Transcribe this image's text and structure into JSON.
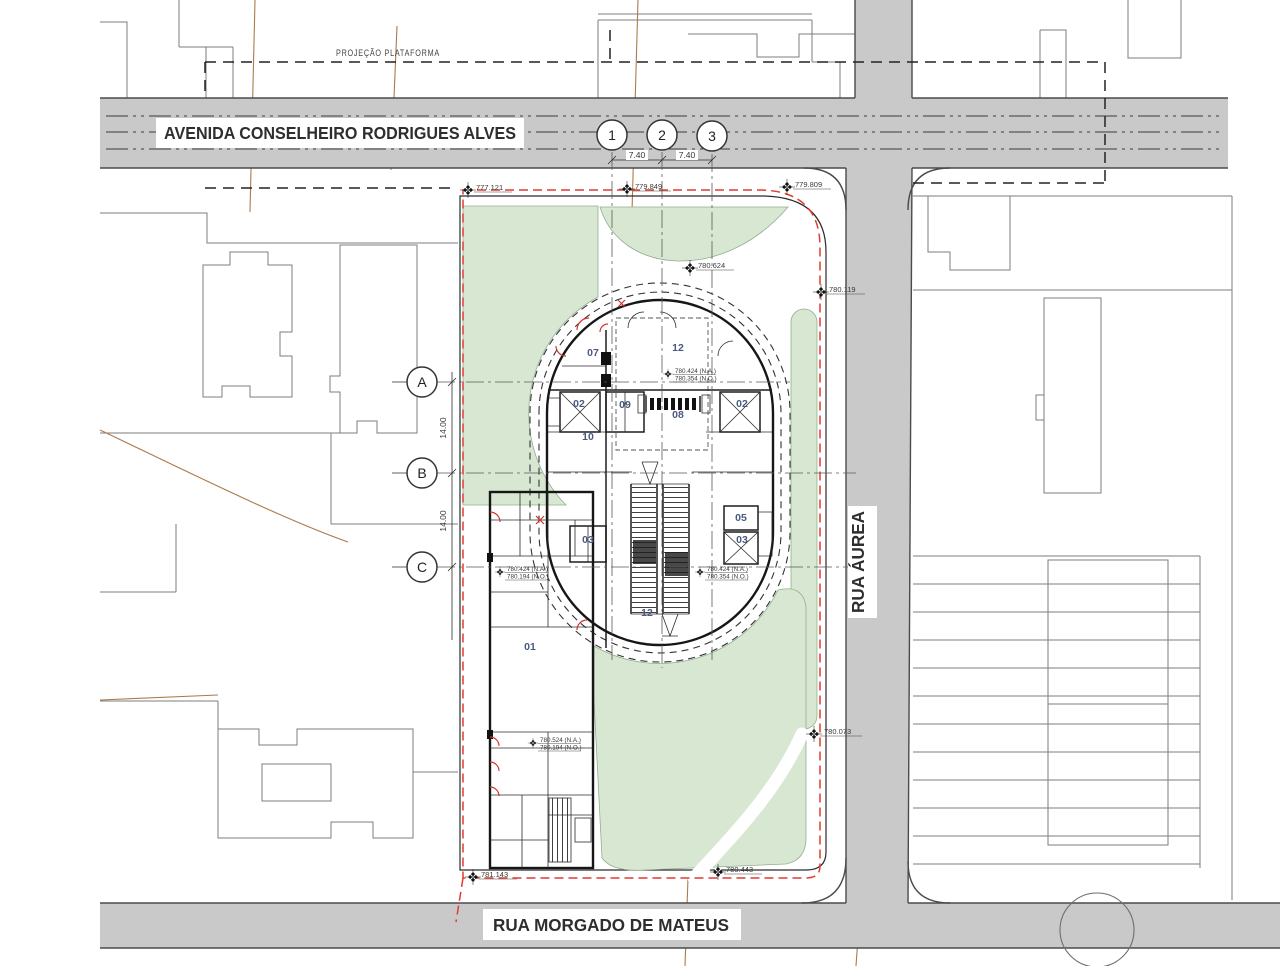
{
  "drawing": {
    "streets": {
      "avenue_top": "AVENIDA CONSELHEIRO RODRIGUES ALVES",
      "street_right": "RUA ÁUREA",
      "street_bottom": "RUA MORGADO DE MATEUS"
    },
    "notes": {
      "platform_projection": "PROJEÇÃO PLATAFORMA"
    },
    "grid": {
      "columns": [
        "1",
        "2",
        "3"
      ],
      "column_spacings": [
        "7.40",
        "7.40"
      ],
      "rows": [
        "A",
        "B",
        "C"
      ],
      "row_spacings": [
        "14.00",
        "14.00"
      ]
    },
    "rooms": [
      "07",
      "12",
      "02",
      "09",
      "08",
      "02",
      "10",
      "05",
      "03",
      "03",
      "12",
      "01"
    ],
    "survey_markers": [
      "777.121",
      "779.849",
      "779.809",
      "780.624",
      "780.119",
      "780.073",
      "781.143",
      "780.443"
    ],
    "level_notes": [
      {
        "na": "780.424 (N.A.)",
        "no": "780.354 (N.O.)"
      },
      {
        "na": "780.424 (N.A.)",
        "no": "780.354 (N.O.)"
      },
      {
        "na": "780.424 (N.A.)",
        "no": "780.194 (N.O.)"
      },
      {
        "na": "780.524 (N.A.)",
        "no": "780.194 (N.O.)"
      }
    ],
    "colors": {
      "street_fill": "#c9c9c9",
      "green_fill": "#d8e7d2",
      "building_fill": "#f8f4e1",
      "boundary_red": "#e23b30",
      "survey_brown": "#ad7a4a"
    }
  }
}
